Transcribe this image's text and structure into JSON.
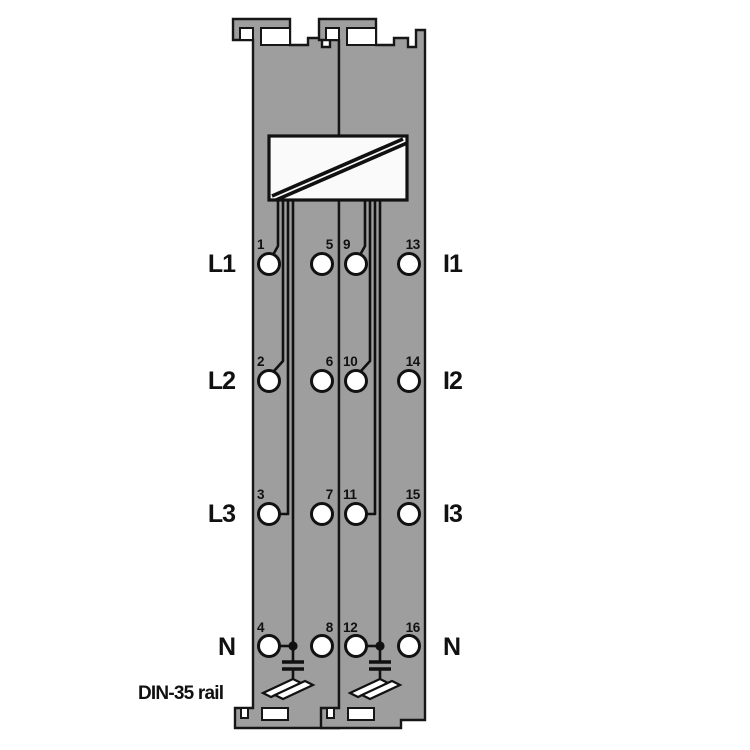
{
  "diagram": {
    "title": "terminal-module-wiring-diagram",
    "caption": "DIN-35 rail",
    "left_labels": [
      "L1",
      "L2",
      "L3",
      "N"
    ],
    "right_labels": [
      "I1",
      "I2",
      "I3",
      "N"
    ],
    "terminal_numbers": [
      "1",
      "2",
      "3",
      "4",
      "5",
      "6",
      "7",
      "8",
      "9",
      "10",
      "11",
      "12",
      "13",
      "14",
      "15",
      "16"
    ],
    "symbols": [
      "converter-box",
      "capacitor",
      "din-rail-contact"
    ],
    "colors": {
      "module_body": "#9e9e9e",
      "outline": "#111111",
      "terminal_fill": "#ffffff",
      "background": "#ffffff"
    }
  }
}
